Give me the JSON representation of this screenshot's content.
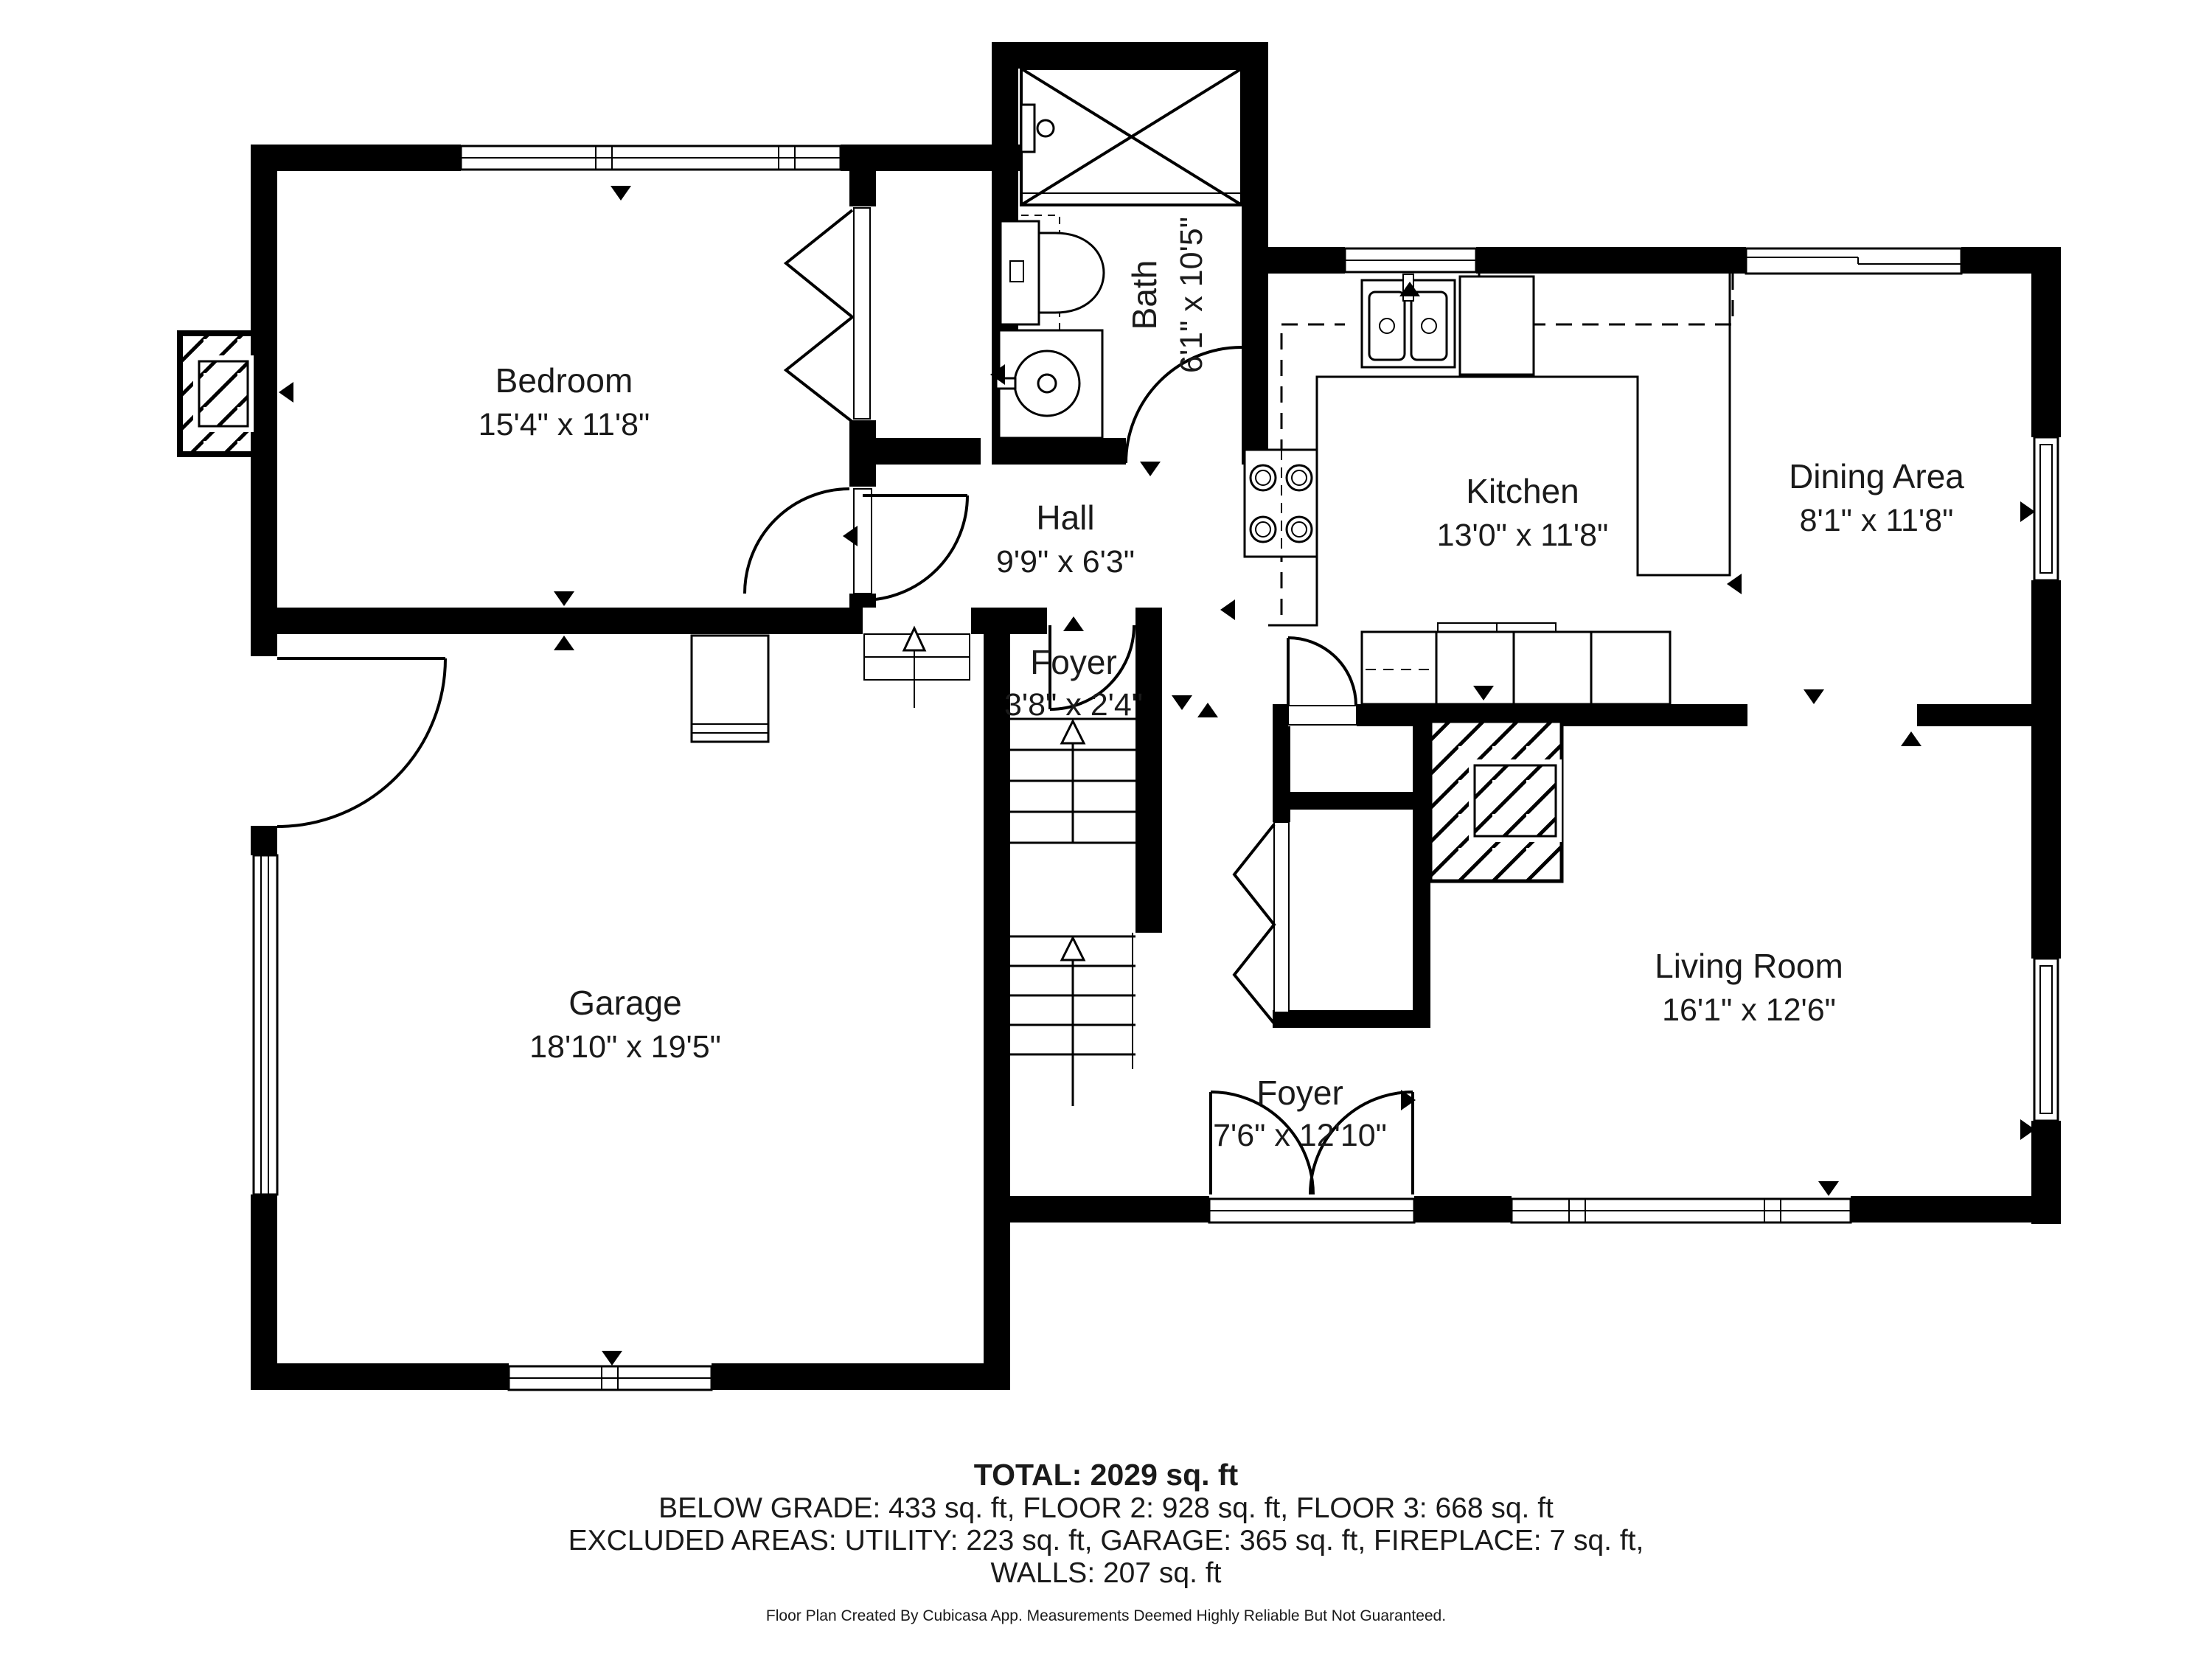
{
  "plan": {
    "rooms": [
      {
        "name": "Bedroom",
        "dims": "15'4\" x 11'8\""
      },
      {
        "name": "Bath",
        "dims": "6'1\" x 10'5\""
      },
      {
        "name": "Hall",
        "dims": "9'9\" x 6'3\""
      },
      {
        "name": "Kitchen",
        "dims": "13'0\" x 11'8\""
      },
      {
        "name": "Dining Area",
        "dims": "8'1\" x 11'8\""
      },
      {
        "name": "Foyer",
        "dims": "3'8\" x 2'4\""
      },
      {
        "name": "Garage",
        "dims": "18'10\" x 19'5\""
      },
      {
        "name": "Living Room",
        "dims": "16'1\" x 12'6\""
      },
      {
        "name": "Foyer",
        "dims": "7'6\" x 12'10\""
      }
    ],
    "summary": {
      "total": "TOTAL: 2029 sq. ft",
      "floors": "BELOW GRADE: 433 sq. ft, FLOOR 2: 928 sq. ft, FLOOR 3: 668 sq. ft",
      "excluded": "EXCLUDED AREAS: UTILITY: 223 sq. ft, GARAGE: 365 sq. ft, FIREPLACE: 7 sq. ft,",
      "walls": "WALLS: 207 sq. ft"
    },
    "disclaimer": "Floor Plan Created By Cubicasa App. Measurements Deemed Highly Reliable But Not Guaranteed.",
    "colors": {
      "wall": "#000000",
      "background": "#ffffff",
      "text": "#1a1a1a"
    }
  }
}
